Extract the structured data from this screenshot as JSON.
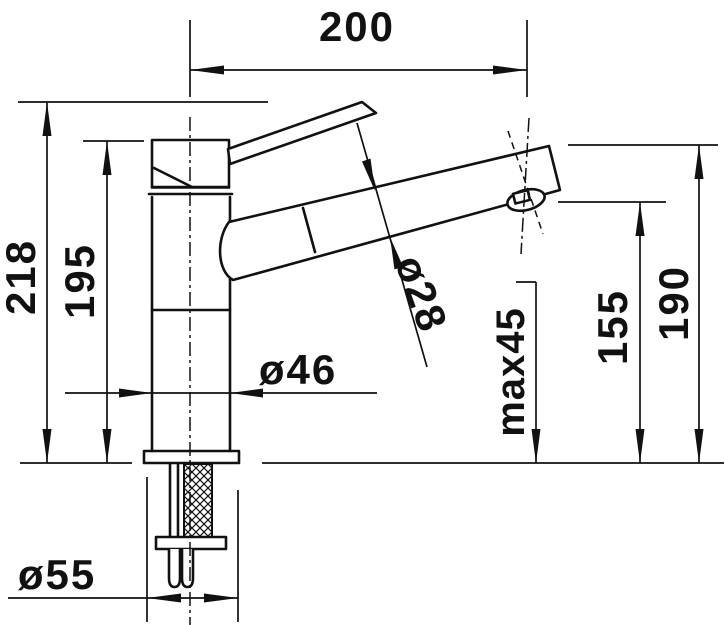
{
  "drawing": {
    "type": "faucet-dimension-drawing",
    "background_color": "#ffffff",
    "line_color": "#111111",
    "dims": {
      "reach": "200",
      "total_height": "218",
      "body_height": "195",
      "body_diameter": "ø46",
      "spout_diameter": "ø28",
      "max_mounting": "max45",
      "outlet_height": "155",
      "spout_tip_height": "190",
      "base_diameter": "ø55"
    }
  }
}
